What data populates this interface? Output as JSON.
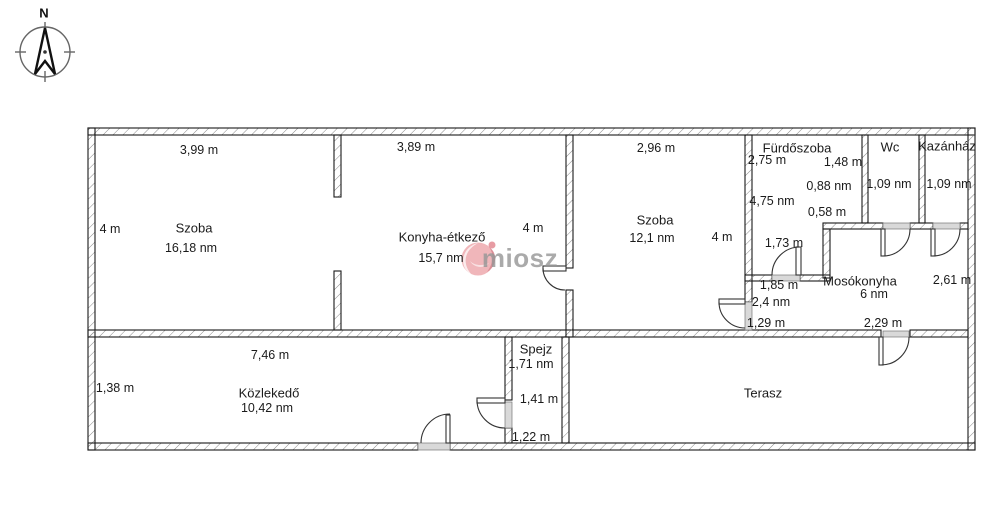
{
  "compass": {
    "label": "N"
  },
  "watermark": {
    "text": "miosz",
    "logo_color": "#E88A90",
    "text_color": "#969696"
  },
  "colors": {
    "wall_outline": "#1a1a1a",
    "wall_hatch": "#8a8a8a",
    "door_sill": "#d9d9d9"
  },
  "rooms": {
    "szoba1": {
      "name": "Szoba",
      "area": "16,18 nm",
      "dim_top": "3,99 m",
      "dim_left": "4 m"
    },
    "konyha": {
      "name": "Konyha-étkező",
      "area": "15,7 nm",
      "dim_top": "3,89 m",
      "dim_right": "4 m"
    },
    "szoba2": {
      "name": "Szoba",
      "area": "12,1 nm",
      "dim_top": "2,96 m",
      "dim_right": "4 m"
    },
    "furdoszoba": {
      "name": "Fürdőszoba",
      "dim_width": "2,75 m",
      "area": "4,75 nm",
      "dim_height": "1,73 m",
      "dim_niche_w": "1,48 m",
      "area_niche": "0,88 nm",
      "dim_niche_h": "0,58 m"
    },
    "wc": {
      "name": "Wc",
      "area": "1,09 nm"
    },
    "kazanhaz": {
      "name": "Kazánház",
      "area": "1,09 nm"
    },
    "eloter": {
      "dim_width": "1,85 m",
      "area": "2,4 nm",
      "dim_height": "1,29 m"
    },
    "mosokonyha": {
      "name": "Mosókonyha",
      "area": "6 nm",
      "dim_right": "2,61 m",
      "dim_bottom": "2,29 m"
    },
    "kozlekedo": {
      "name": "Közlekedő",
      "area": "10,42 nm",
      "dim_top": "7,46 m",
      "dim_left": "1,38 m"
    },
    "spejz": {
      "name": "Spejz",
      "area": "1,71 nm",
      "dim_mid": "1,41 m",
      "dim_bottom": "1,22 m"
    },
    "terasz": {
      "name": "Terasz"
    }
  }
}
